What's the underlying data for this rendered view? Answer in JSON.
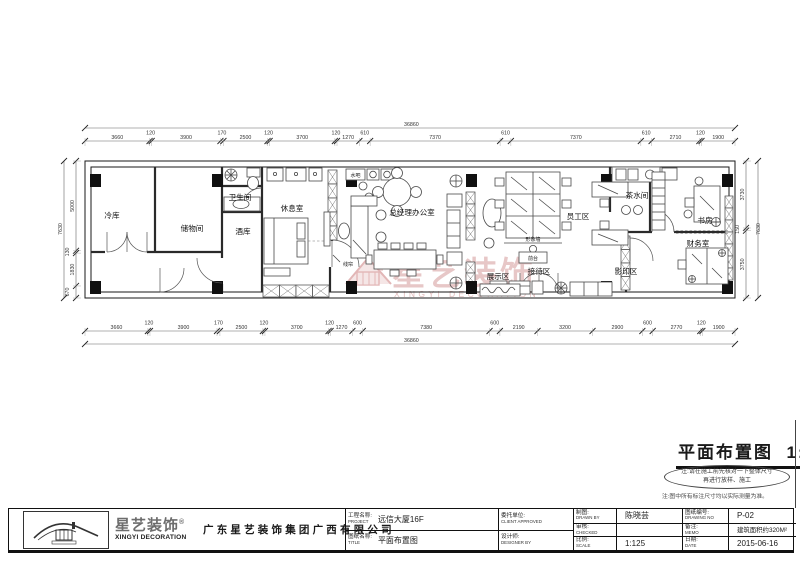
{
  "sheet": {
    "drawing_title": "平面布置图",
    "drawing_scale": "1:125",
    "note_ellipse_line1": "注:请在施工前先核对一下整体尺寸",
    "note_ellipse_line2": "再进行放样、施工",
    "note_line": "注:图中所有标注尺寸均以实际测量为准。"
  },
  "watermark": {
    "brand_cn": "星艺装饰",
    "reg": "®",
    "brand_en": "XINGYI DECORATION"
  },
  "plan": {
    "rooms": [
      {
        "name": "冷库"
      },
      {
        "name": "储物间"
      },
      {
        "name": "卫生间"
      },
      {
        "name": "酒库"
      },
      {
        "name": "休息室"
      },
      {
        "name": "总经理办公室"
      },
      {
        "name": "员工区"
      },
      {
        "name": "茶水间"
      },
      {
        "name": "书房"
      },
      {
        "name": "财务室"
      },
      {
        "name": "展示区"
      },
      {
        "name": "接待区"
      },
      {
        "name": "影印区"
      }
    ],
    "small_labels": [
      {
        "name": "水吧"
      },
      {
        "name": "线帘"
      },
      {
        "name": "形象墙"
      },
      {
        "name": "前台"
      }
    ],
    "dims": {
      "top": {
        "segments": [
          3660,
          120,
          3900,
          170,
          2500,
          120,
          3700,
          120,
          1270,
          610,
          7370,
          610,
          7370,
          610,
          2710,
          120,
          1900
        ],
        "total": "36860"
      },
      "bottom": {
        "segments": [
          3660,
          120,
          3900,
          170,
          2500,
          120,
          3700,
          120,
          1270,
          600,
          7380,
          600,
          2190,
          3200,
          2900,
          600,
          2770,
          120,
          1900
        ],
        "total": "36860"
      },
      "left": {
        "segments": [
          5000,
          130,
          1830,
          670
        ],
        "total": "7630"
      },
      "right": {
        "segments": [
          3730,
          150,
          3750
        ],
        "total": "7630"
      }
    }
  },
  "title_block": {
    "brand_cn": "星艺装饰",
    "reg": "®",
    "brand_en": "XINGYI DECORATION",
    "company": "广东星艺装饰集团广西有限公司",
    "project_label": "工程名称:",
    "project_label_en": "PROJECT",
    "project_value": "远信大厦16F",
    "client_label": "委托单位:",
    "client_label_en": "CLIENT APPROVED",
    "client_value": "",
    "title_label": "图纸名称:",
    "title_label_en": "TITLE",
    "title_value": "平面布置图",
    "designer_label": "设计师:",
    "designer_label_en": "DESIGNER BY",
    "designer_value": "",
    "drawn_label": "制图:",
    "drawn_label_en": "DRAWN BY",
    "drawn_value": "陈晓芸",
    "no_label": "图纸编号:",
    "no_label_en": "DRAWING NO",
    "no_value": "P-02",
    "checked_label": "审核:",
    "checked_label_en": "CHECKED",
    "checked_value": "",
    "memo_label": "备注:",
    "memo_label_en": "MEMO",
    "memo_value": "建筑面积约320M²",
    "scale_label": "比例:",
    "scale_label_en": "SCALE",
    "scale_value": "1:125",
    "date_label": "日期:",
    "date_label_en": "DATE",
    "date_value": "2015-06-16"
  },
  "colors": {
    "ink": "#1a1a1a",
    "watermark_pink": "#cf8f8f",
    "logo_red": "#c06060"
  }
}
